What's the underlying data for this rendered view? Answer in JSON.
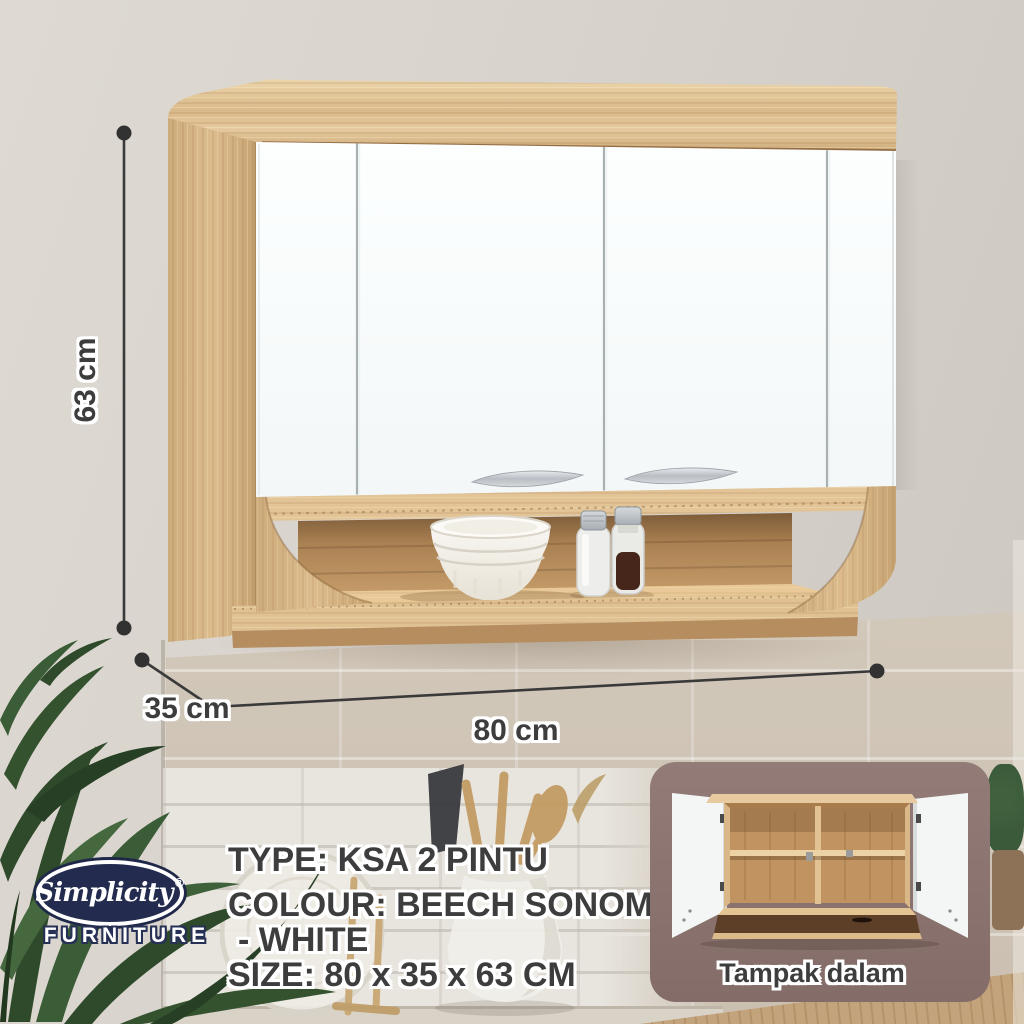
{
  "brand": {
    "name": "Simplicity",
    "registered_mark": "®",
    "tagline": "FURNITURE"
  },
  "product": {
    "type_label": "TYPE: KSA 2 PINTU",
    "colour_label_line1": "COLOUR: BEECH SONOMA",
    "colour_label_line2": "- WHITE",
    "size_label": "SIZE: 80 x 35 x 63 CM"
  },
  "dimensions": {
    "height_label": "63 cm",
    "depth_label": "35 cm",
    "width_label": "80 cm"
  },
  "inset": {
    "caption": "Tampak dalam"
  },
  "colors": {
    "wall_gray": "#d8d3cc",
    "tile_beige": "#cdc2b4",
    "tile_white": "#e8e5df",
    "wood_light": "#e3c496",
    "wood_mid": "#d3ae7d",
    "wood_dark": "#8a5e34",
    "door_white": "#fafdfd",
    "handle_silver": "#bcc1c6",
    "navy": "#232c4e",
    "inset_background": "#8c7470",
    "counter_wood": "#c2a37b",
    "plant_green": "#2e4a2b",
    "text_ink": "#3d3d3d",
    "dimension_ink": "#3a3a3a"
  }
}
